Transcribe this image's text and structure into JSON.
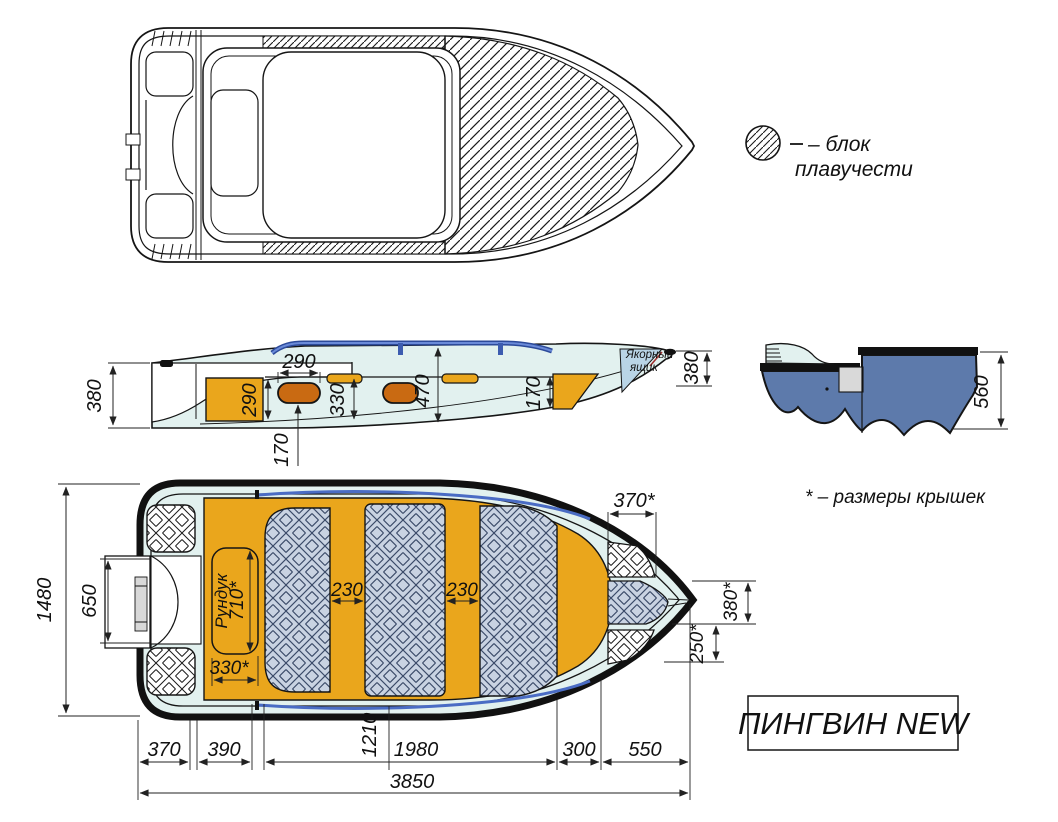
{
  "legend": {
    "line1": "– блок",
    "line2": "плавучести"
  },
  "note": "* – размеры крышек",
  "title": "ПИНГВИН NEW",
  "side_view": {
    "transom_height": "380",
    "seat_length": "290",
    "stern_locker_height": "290",
    "mid_height": "330",
    "cockpit_depth": "470",
    "seat_height": "170",
    "bow_locker_height": "170",
    "bow_height": "380",
    "anchor_line1": "Якорный",
    "anchor_line2": "ящик"
  },
  "section_view": {
    "height": "560"
  },
  "plan_view": {
    "beam": "1480",
    "motor_mount": "650",
    "rundook_label": "Рундук",
    "rundook_length": "710*",
    "rundook_width": "330*",
    "bench1_width": "230",
    "bench2_width": "230",
    "bow_lid_width": "370*",
    "bow_lid_height": "380*",
    "bow_lid2_height": "250*"
  },
  "length_dims": {
    "stern": "370",
    "stern_seat": "390",
    "to_bench": "1210",
    "cockpit": "1980",
    "bow_seat": "300",
    "bow": "550",
    "overall": "3850"
  }
}
